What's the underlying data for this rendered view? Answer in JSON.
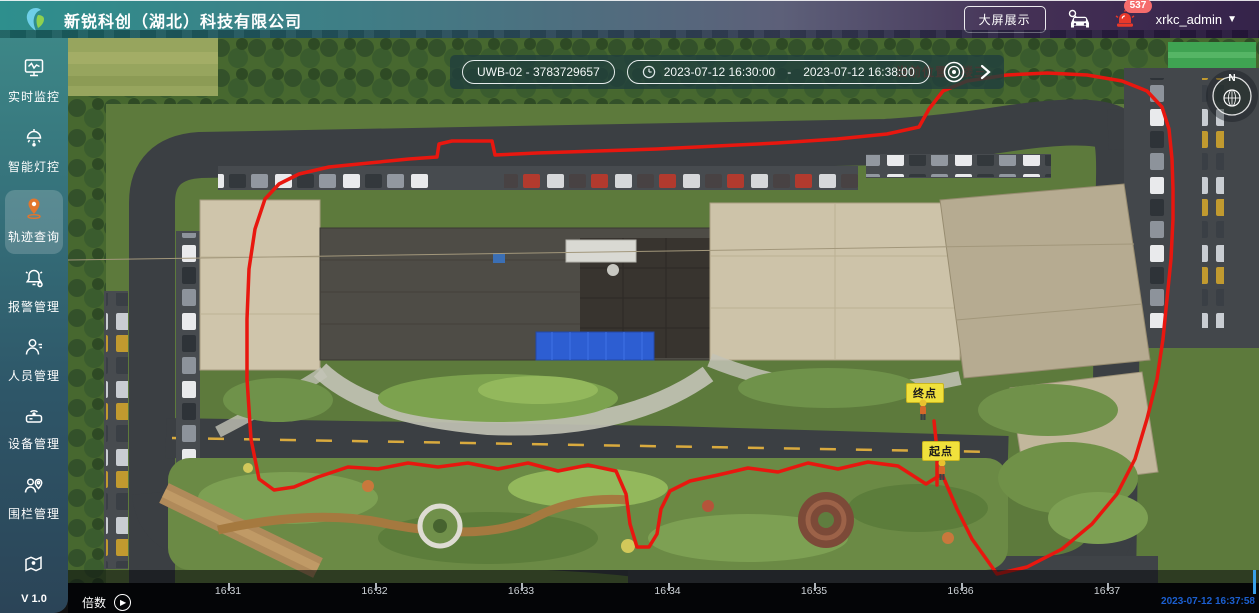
{
  "header": {
    "title": "新锐科创（湖北）科技有限公司",
    "big_screen_button": "大屏展示",
    "notification_count": "537",
    "username": "xrkc_admin",
    "gradient_left": "#2e8f8d",
    "gradient_right": "#35234a"
  },
  "sidebar": {
    "items": [
      {
        "label": "实时监控",
        "icon": "monitor-icon",
        "active": false
      },
      {
        "label": "智能灯控",
        "icon": "smart-light-icon",
        "active": false
      },
      {
        "label": "轨迹查询",
        "icon": "trajectory-pin-icon",
        "active": true
      },
      {
        "label": "报警管理",
        "icon": "alarm-bell-icon",
        "active": false
      },
      {
        "label": "人员管理",
        "icon": "person-icon",
        "active": false
      },
      {
        "label": "设备管理",
        "icon": "device-icon",
        "active": false
      },
      {
        "label": "围栏管理",
        "icon": "fence-icon",
        "active": false
      },
      {
        "label": "",
        "icon": "map-icon",
        "active": false
      }
    ],
    "version": "V 1.0",
    "active_icon_color": "#e2762d"
  },
  "map": {
    "device_select": "UWB-02 - 3783729657",
    "time_start": "2023-07-12 16:30:00",
    "time_separator": "-",
    "time_end": "2023-07-12 16:38:00",
    "alert_text": "当前位置：楼三",
    "alert_color": "#e8170f",
    "compass_label": "N",
    "end_marker_label": "终点",
    "start_marker_label": "起点",
    "trajectory_color": "#e8170f",
    "trajectory_points": "874,436 858,446 830,428 800,424 770,431 740,425 710,434 680,430 650,437 622,443 602,453 593,471 589,496 581,509 569,509 562,486 558,456 548,433 520,427 490,433 460,425 430,431 400,425 370,429 340,425 310,431 280,429 250,439 226,449 206,452 191,441 183,401 179,341 179,281 181,231 187,191 197,161 211,146 231,136 261,129 301,125 341,121 369,119 371,106 384,103 424,103 427,117 469,115 529,113 589,111 649,108 709,105 769,101 819,96 851,89 861,71 875,53 899,43 939,37 979,35 1019,37 1054,43 1079,53 1094,69 1101,91 1104,121 1105,151 1105,181 1103,221 1099,261 1095,301 1089,341 1079,381 1067,421 1049,456 1024,486 994,511 959,529 929,536 904,501 889,471 874,436",
    "branch_points": "869,447 869,412 866,383"
  },
  "timeline": {
    "speed_label": "倍数",
    "ticks": [
      "16:31",
      "16:32",
      "16:33",
      "16:34",
      "16:35",
      "16:36",
      "16:37"
    ],
    "tick_start_x": 160,
    "tick_spacing": 146.5,
    "playhead_x": 1185,
    "playhead_color": "#3aa0e8",
    "current_time": "2023-07-12 16:37:58",
    "current_time_color": "#1b5fd0"
  }
}
